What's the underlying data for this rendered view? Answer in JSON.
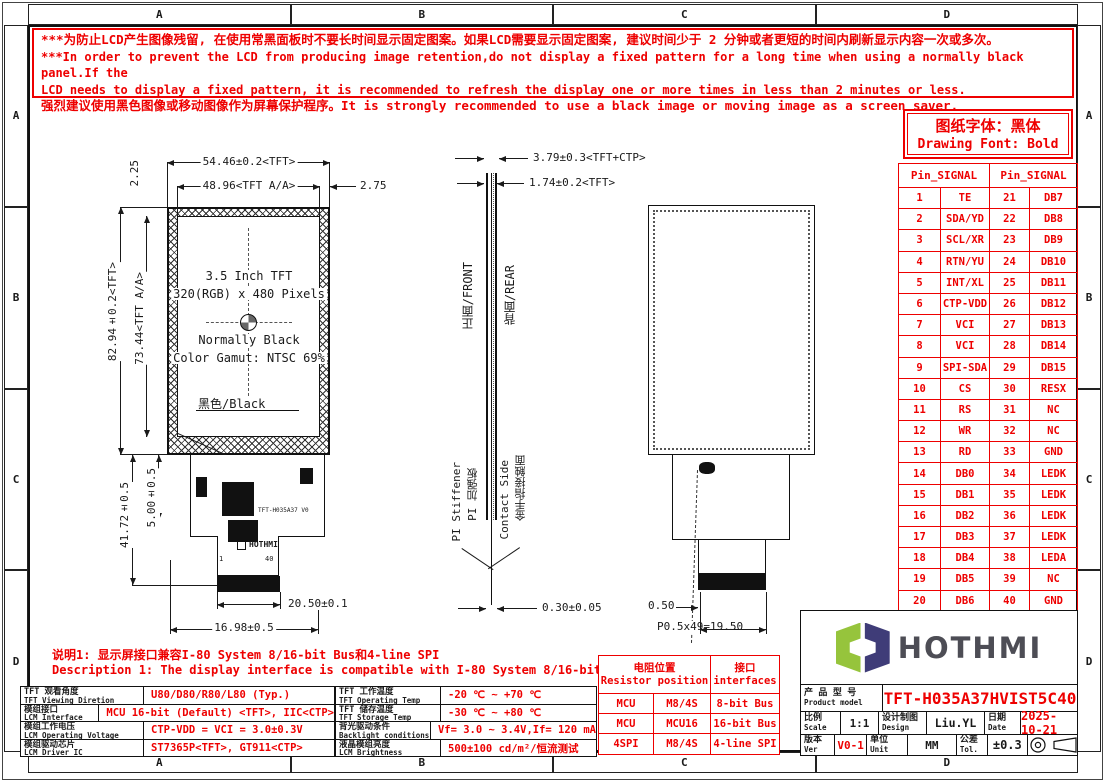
{
  "colors": {
    "red": "#ee0000",
    "line": "#1a1a1a",
    "logo_green": "#96c43c",
    "logo_navy": "#3f3c78",
    "logo_text": "#4d4d55"
  },
  "frame": {
    "top_cols": [
      "A",
      "B",
      "C",
      "D"
    ],
    "bottom_cols": [
      "A",
      "B",
      "C",
      "D"
    ],
    "left_rows": [
      "A",
      "B",
      "C",
      "D"
    ],
    "right_rows": [
      "A",
      "B",
      "C",
      "D"
    ]
  },
  "warning": {
    "line1": "***为防止LCD产生图像残留, 在使用常黑面板时不要长时间显示固定图案。如果LCD需要显示固定图案, 建议时间少于 2 分钟或者更短的时间内刷新显示内容一次或多次。",
    "line2": "***In order to prevent the LCD from producing image retention,do not display a fixed pattern for a long time when using a normally black panel.If the",
    "line3": " LCD needs to display a fixed pattern, it is recommended to refresh the display one or more times in less than 2 minutes or less.",
    "line4": "强烈建议使用黑色图像或移动图像作为屏幕保护程序。It is strongly recommended to use a black image or moving image as a screen saver."
  },
  "font_note": {
    "zh": "图纸字体：黑体",
    "en": "Drawing Font: Bold"
  },
  "pin_table": {
    "header_left": "Pin_SIGNAL",
    "header_right": "Pin_SIGNAL",
    "rows": [
      [
        "1",
        "TE",
        "21",
        "DB7"
      ],
      [
        "2",
        "SDA/YD",
        "22",
        "DB8"
      ],
      [
        "3",
        "SCL/XR",
        "23",
        "DB9"
      ],
      [
        "4",
        "RTN/YU",
        "24",
        "DB10"
      ],
      [
        "5",
        "INT/XL",
        "25",
        "DB11"
      ],
      [
        "6",
        "CTP-VDD",
        "26",
        "DB12"
      ],
      [
        "7",
        "VCI",
        "27",
        "DB13"
      ],
      [
        "8",
        "VCI",
        "28",
        "DB14"
      ],
      [
        "9",
        "SPI-SDA",
        "29",
        "DB15"
      ],
      [
        "10",
        "CS",
        "30",
        "RESX"
      ],
      [
        "11",
        "RS",
        "31",
        "NC"
      ],
      [
        "12",
        "WR",
        "32",
        "NC"
      ],
      [
        "13",
        "RD",
        "33",
        "GND"
      ],
      [
        "14",
        "DB0",
        "34",
        "LEDK"
      ],
      [
        "15",
        "DB1",
        "35",
        "LEDK"
      ],
      [
        "16",
        "DB2",
        "36",
        "LEDK"
      ],
      [
        "17",
        "DB3",
        "37",
        "LEDK"
      ],
      [
        "18",
        "DB4",
        "38",
        "LEDA"
      ],
      [
        "19",
        "DB5",
        "39",
        "NC"
      ],
      [
        "20",
        "DB6",
        "40",
        "GND"
      ]
    ]
  },
  "front_view": {
    "dim_width_tft": "54.46±0.2<TFT>",
    "dim_width_aa": "48.96<TFT A/A>",
    "dim_right": "2.75",
    "dim_top": "2.25",
    "dim_height_tft": "82.94±0.2<TFT>",
    "dim_height_aa": "73.44<TFT A/A>",
    "line1": "3.5 Inch TFT",
    "line2": "320(RGB) x 480 Pixels",
    "line3": "Normally Black",
    "line4": "Color Gamut: NTSC 69%",
    "black_label": "黑色/Black",
    "fpc_label": "TFT-H035A37 V0",
    "fpc_logo": "HOTHMI",
    "pin_first": "1",
    "pin_last": "40",
    "dim_fpc_len": "41.72±0.5",
    "dim_fpc_5": "5.00±0.5",
    "dim_conn_w": "20.50±0.1",
    "dim_conn_off": "16.98±0.5"
  },
  "side_view": {
    "dim_total": "3.79±0.3<TFT+CTP>",
    "dim_tft": "1.74±0.2<TFT>",
    "front_label": "正面/FRONT",
    "rear_label": "背面/REAR",
    "stiffener_en": "PI Stiffener",
    "stiffener_zh": "PI 加强板",
    "contact_en": "Contact Side",
    "contact_zh": "金手指接触面",
    "dim_thickness": "0.30±0.05"
  },
  "rear_view": {
    "dim_offset": "0.50",
    "dim_pitch": "P0.5x49=19.50"
  },
  "note": {
    "zh": "说明1: 显示屏接口兼容I-80 System 8/16-bit Bus和4-line SPI",
    "en": "Description 1: The display interface is compatible with I-80 System 8/16-bit Bus and 4-line SPI."
  },
  "spec_left": {
    "rows": [
      {
        "zh": "TFT 观看角度",
        "en": "TFT Viewing Diretion",
        "value": "U80/D80/R80/L80 (Typ.)"
      },
      {
        "zh": "模组接口",
        "en": "LCM Interface",
        "value": "MCU 16-bit (Default) <TFT>, IIC<CTP>"
      },
      {
        "zh": "模组工作电压",
        "en": "LCM Operating Voltage",
        "value": "CTP-VDD = VCI = 3.0±0.3V"
      },
      {
        "zh": "模组驱动芯片",
        "en": "LCM Driver IC",
        "value": "ST7365P<TFT>, GT911<CTP>"
      }
    ]
  },
  "spec_mid": {
    "rows": [
      {
        "zh": "TFT 工作温度",
        "en": "TFT Operating Temp",
        "value": "-20 ℃ ~ +70 ℃"
      },
      {
        "zh": "TFT 储存温度",
        "en": "TFT Storage Temp",
        "value": "-30 ℃ ~ +80 ℃"
      },
      {
        "zh": "背光驱动条件",
        "en": "Backlight conditions",
        "value": "Vf= 3.0 ~ 3.4V,If= 120 mA"
      },
      {
        "zh": "液晶模组亮度",
        "en": "LCM Brightness",
        "value": "500±100  cd/m²/恒流测试"
      }
    ]
  },
  "resistor_table": {
    "header_pos_zh": "电阻位置",
    "header_pos_en": "Resistor position",
    "header_if_zh": "接口",
    "header_if_en": "interfaces",
    "rows": [
      {
        "pos": "MCU",
        "res": "M8/4S",
        "iface": "8-bit Bus"
      },
      {
        "pos": "MCU",
        "res": "MCU16",
        "iface": "16-bit Bus"
      },
      {
        "pos": "4SPI",
        "res": "M8/4S",
        "iface": "4-line SPI"
      }
    ]
  },
  "title_block": {
    "logo_text": "HOTHMI",
    "model_zh": "产 品 型 号",
    "model_en": "Product model",
    "model_value": "TFT-H035A37HVIST5C40",
    "scale_zh": "比例",
    "scale_en": "Scale",
    "scale_value": "1:1",
    "design_zh": "设计制图",
    "design_en": "Design",
    "design_value": "Liu.YL",
    "date_zh": "日期",
    "date_en": "Date",
    "date_value": "2025-10-21",
    "ver_zh": "版本",
    "ver_en": "Ver",
    "ver_value": "V0-1",
    "unit_zh": "单位",
    "unit_en": "Unit",
    "unit_value": "MM",
    "tol_zh": "公差",
    "tol_en": "Tol.",
    "tol_value": "±0.3"
  }
}
